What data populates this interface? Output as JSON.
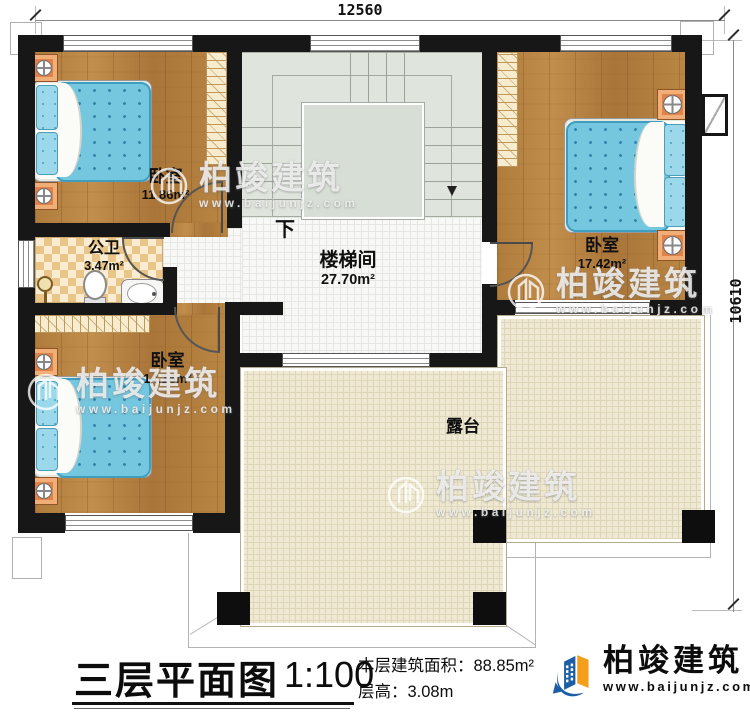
{
  "dimensions": {
    "top": "12560",
    "right": "10610"
  },
  "rooms": {
    "bedroom_top_left": {
      "name": "卧室",
      "area": "11.86m²"
    },
    "bathroom": {
      "name": "公卫",
      "area": "3.47m²"
    },
    "bedroom_bottom_left": {
      "name": "卧室",
      "area": "14.16m²"
    },
    "stairwell": {
      "name": "楼梯间",
      "area": "27.70m²",
      "direction_label": "下"
    },
    "bedroom_right": {
      "name": "卧室",
      "area": "17.42m²"
    },
    "terrace": {
      "name": "露台"
    }
  },
  "title_block": {
    "title": "三层平面图",
    "scale": "1:100",
    "floor_area_label": "本层建筑面积：",
    "floor_area_value": "88.85m²",
    "floor_height_label": "层高：",
    "floor_height_value": "3.08m"
  },
  "branding": {
    "company": "柏竣建筑",
    "website": "www.baijunjz.com"
  },
  "watermark": {
    "company": "柏竣建筑",
    "website": "www.baijunjz.com"
  }
}
